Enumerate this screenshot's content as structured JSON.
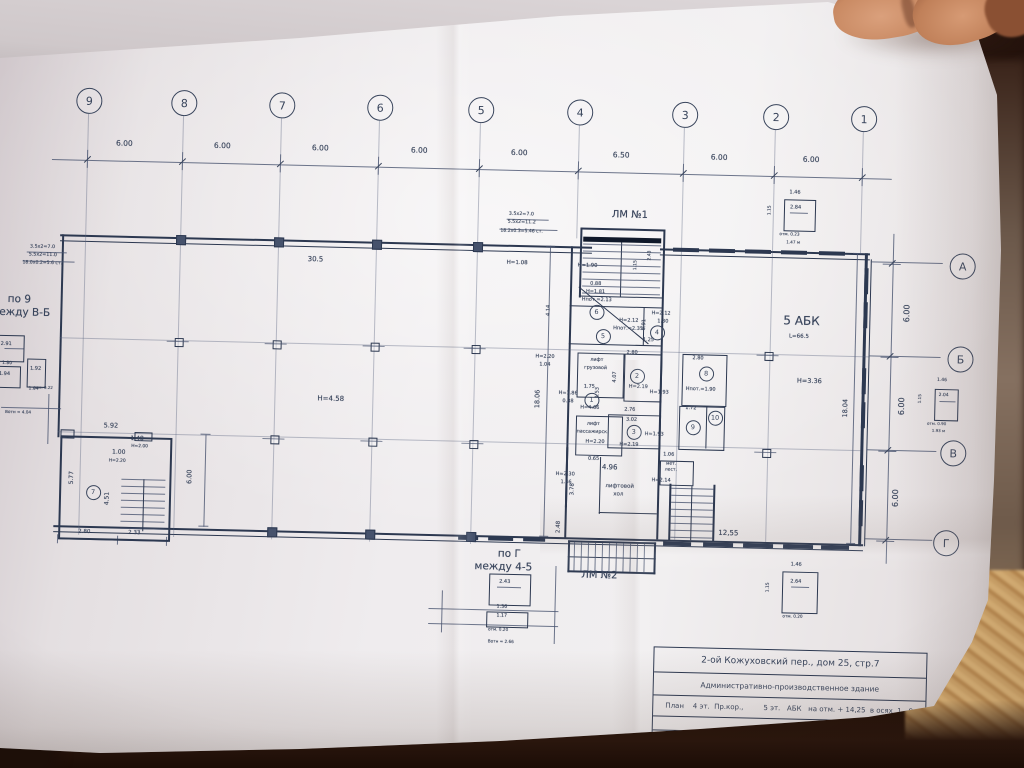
{
  "colors": {
    "ink": "#39455c",
    "paper": "#efecee",
    "background": "#2c1810",
    "carpet": "#c79e66",
    "skin": "#c98a63"
  },
  "title_block": {
    "address": "2-ой Кожуховский пер., дом 25, стр.7",
    "building": "Административно-производственное здание",
    "plan_line": "План    4 эт.  Пр.кор.,         5 эт.   АБК   на отм. + 14,25  в осях  1 - 9",
    "executor_label": "Выполнил",
    "author": "Панова А.А.",
    "date": "10.10.06"
  },
  "axis_top": {
    "bubbles": [
      {
        "n": "9",
        "x": 80
      },
      {
        "n": "8",
        "x": 175
      },
      {
        "n": "7",
        "x": 273
      },
      {
        "n": "6",
        "x": 371
      },
      {
        "n": "5",
        "x": 472
      },
      {
        "n": "4",
        "x": 571
      },
      {
        "n": "3",
        "x": 676
      },
      {
        "n": "2",
        "x": 767
      },
      {
        "n": "1",
        "x": 855
      }
    ],
    "dims": [
      {
        "t": "6.00",
        "x": 117
      },
      {
        "t": "6.00",
        "x": 215
      },
      {
        "t": "6.00",
        "x": 313
      },
      {
        "t": "6.00",
        "x": 412
      },
      {
        "t": "6.00",
        "x": 512
      },
      {
        "t": "6.50",
        "x": 614
      },
      {
        "t": "6.00",
        "x": 712
      },
      {
        "t": "6.00",
        "x": 804
      }
    ]
  },
  "axis_right": {
    "bubbles": [
      {
        "n": "А",
        "x": 957,
        "y": 213
      },
      {
        "n": "Б",
        "x": 957,
        "y": 306
      },
      {
        "n": "В",
        "x": 952,
        "y": 400
      },
      {
        "n": "Г",
        "x": 947,
        "y": 490
      }
    ],
    "dims": [
      {
        "t": "6.00",
        "x": 905,
        "y": 262
      },
      {
        "t": "6.00",
        "x": 902,
        "y": 355
      },
      {
        "t": "6.00",
        "x": 898,
        "y": 447
      }
    ]
  },
  "room_bubbles": [
    {
      "n": "7",
      "x": 93,
      "y": 459
    },
    {
      "n": "6",
      "x": 592,
      "y": 267
    },
    {
      "n": "5",
      "x": 599,
      "y": 291
    },
    {
      "n": "4",
      "x": 653,
      "y": 286
    },
    {
      "n": "2",
      "x": 634,
      "y": 330
    },
    {
      "n": "3",
      "x": 632,
      "y": 386
    },
    {
      "n": "1",
      "x": 589,
      "y": 355
    },
    {
      "n": "8",
      "x": 703,
      "y": 326
    },
    {
      "n": "10",
      "x": 713,
      "y": 370
    },
    {
      "n": "9",
      "x": 691,
      "y": 380
    }
  ],
  "annotations": [
    {
      "t": "ЛМ №1",
      "x": 606,
      "y": 166,
      "fs": 10
    },
    {
      "t": "ЛМ №2",
      "x": 584,
      "y": 527,
      "fs": 10
    },
    {
      "t": "по 9",
      "x": 4,
      "y": 264,
      "fs": 10.5
    },
    {
      "t": "между В-Б",
      "x": -12,
      "y": 277,
      "fs": 10.5
    },
    {
      "t": "по Г",
      "x": 500,
      "y": 507,
      "fs": 10.5
    },
    {
      "t": "между 4-5",
      "x": 477,
      "y": 520,
      "fs": 10.5
    },
    {
      "t": "5 АБК",
      "x": 780,
      "y": 266,
      "fs": 12
    },
    {
      "t": "L=66.5",
      "x": 786,
      "y": 286,
      "fs": 5.5
    },
    {
      "t": "Н=3.36",
      "x": 795,
      "y": 329,
      "fs": 6.5
    },
    {
      "t": "30.5",
      "x": 303,
      "y": 219,
      "fs": 7
    },
    {
      "t": "Н=4.58",
      "x": 316,
      "y": 358,
      "fs": 7
    },
    {
      "t": "3.5х2=7.0",
      "x": 25,
      "y": 214,
      "fs": 4.8
    },
    {
      "t": "5.5х2=11.0",
      "x": 24,
      "y": 222,
      "fs": 4.8
    },
    {
      "t": "18.0х0.2=5.6 ст.",
      "x": 18,
      "y": 231,
      "fs": 4.6
    },
    {
      "t": "3.5х2=7.0",
      "x": 503,
      "y": 170,
      "fs": 4.8
    },
    {
      "t": "5.5х2=11.2",
      "x": 502,
      "y": 178,
      "fs": 4.8
    },
    {
      "t": "18.2х0.3=5.46 ст.",
      "x": 495,
      "y": 188,
      "fs": 4.6
    },
    {
      "t": "Н=1.08",
      "x": 502,
      "y": 219,
      "fs": 5.5
    },
    {
      "t": "Н=1.90",
      "x": 573,
      "y": 220,
      "fs": 5.2
    },
    {
      "t": "0.88",
      "x": 586,
      "y": 238,
      "fs": 5
    },
    {
      "t": "Н=1.81",
      "x": 582,
      "y": 246,
      "fs": 5
    },
    {
      "t": "Нпот.=2.13",
      "x": 578,
      "y": 254,
      "fs": 5
    },
    {
      "t": "Н=2.12",
      "x": 616,
      "y": 274,
      "fs": 5
    },
    {
      "t": "Нпот.=2.35",
      "x": 610,
      "y": 282,
      "fs": 5
    },
    {
      "t": "Н=2.12",
      "x": 648,
      "y": 266,
      "fs": 5
    },
    {
      "t": "1.30",
      "x": 654,
      "y": 274,
      "fs": 5
    },
    {
      "t": "1.25",
      "x": 640,
      "y": 293,
      "fs": 5
    },
    {
      "t": "2.80",
      "x": 624,
      "y": 306,
      "fs": 5
    },
    {
      "t": "2.80",
      "x": 690,
      "y": 310,
      "fs": 5
    },
    {
      "t": "Нпот.=1.90",
      "x": 684,
      "y": 341,
      "fs": 5
    },
    {
      "t": "1.72",
      "x": 684,
      "y": 360,
      "fs": 5
    },
    {
      "t": "4.14",
      "x": 550,
      "y": 268,
      "fs": 5,
      "r": 1
    },
    {
      "t": "0.91",
      "x": 646,
      "y": 280,
      "fs": 5,
      "r": 1
    },
    {
      "t": "4.07",
      "x": 618,
      "y": 333,
      "fs": 5,
      "r": 1
    },
    {
      "t": "2.76",
      "x": 623,
      "y": 363,
      "fs": 5
    },
    {
      "t": "3.02",
      "x": 625,
      "y": 373,
      "fs": 5
    },
    {
      "t": "Н=1.93",
      "x": 648,
      "y": 345,
      "fs": 5
    },
    {
      "t": "Н=1.93",
      "x": 644,
      "y": 387,
      "fs": 5
    },
    {
      "t": "Н=2.19",
      "x": 627,
      "y": 340,
      "fs": 5
    },
    {
      "t": "Н=2.19",
      "x": 619,
      "y": 398,
      "fs": 5
    },
    {
      "t": "Н=2.20",
      "x": 533,
      "y": 312,
      "fs": 5
    },
    {
      "t": "1.04",
      "x": 537,
      "y": 320,
      "fs": 5
    },
    {
      "t": "Н=1.86",
      "x": 557,
      "y": 348,
      "fs": 5
    },
    {
      "t": "0.88",
      "x": 561,
      "y": 356,
      "fs": 5
    },
    {
      "t": "1.75",
      "x": 582,
      "y": 341,
      "fs": 5
    },
    {
      "t": "1.53",
      "x": 601,
      "y": 349,
      "fs": 5,
      "r": 1
    },
    {
      "t": "Н=4.66",
      "x": 579,
      "y": 362,
      "fs": 5
    },
    {
      "t": "лифт",
      "x": 588,
      "y": 314,
      "fs": 4.8
    },
    {
      "t": "грузовой",
      "x": 582,
      "y": 322,
      "fs": 4.8
    },
    {
      "t": "лифт",
      "x": 586,
      "y": 378,
      "fs": 4.8
    },
    {
      "t": "пассажирск.",
      "x": 576,
      "y": 386,
      "fs": 4.8
    },
    {
      "t": "Н=2.20",
      "x": 585,
      "y": 396,
      "fs": 5
    },
    {
      "t": "18.06",
      "x": 537,
      "y": 356,
      "fs": 6.5,
      "r": 1
    },
    {
      "t": "18.04",
      "x": 845,
      "y": 358,
      "fs": 6.5,
      "r": 1
    },
    {
      "t": "0.65",
      "x": 588,
      "y": 413,
      "fs": 5
    },
    {
      "t": "4.96",
      "x": 602,
      "y": 420,
      "fs": 7
    },
    {
      "t": "Н=2.30",
      "x": 556,
      "y": 429,
      "fs": 5
    },
    {
      "t": "1.46",
      "x": 561,
      "y": 437,
      "fs": 5
    },
    {
      "t": "3.78",
      "x": 578,
      "y": 446,
      "fs": 5.5,
      "r": 1
    },
    {
      "t": "лифтовой",
      "x": 606,
      "y": 440,
      "fs": 5.5
    },
    {
      "t": "хол",
      "x": 614,
      "y": 448,
      "fs": 5.5
    },
    {
      "t": "мет.",
      "x": 666,
      "y": 417,
      "fs": 4.5
    },
    {
      "t": "лест.",
      "x": 665,
      "y": 423,
      "fs": 4.5
    },
    {
      "t": "1.06",
      "x": 663,
      "y": 407,
      "fs": 5
    },
    {
      "t": "Н=2.14",
      "x": 652,
      "y": 433,
      "fs": 5
    },
    {
      "t": "2.48",
      "x": 565,
      "y": 484,
      "fs": 5.5,
      "r": 1
    },
    {
      "t": "12,55",
      "x": 720,
      "y": 483,
      "fs": 7
    },
    {
      "t": "5.92",
      "x": 103,
      "y": 390,
      "fs": 6.5
    },
    {
      "t": "1.48",
      "x": 130,
      "y": 403,
      "fs": 6
    },
    {
      "t": "1.00",
      "x": 112,
      "y": 417,
      "fs": 6
    },
    {
      "t": "Н=2.00",
      "x": 131,
      "y": 412,
      "fs": 4.4
    },
    {
      "t": "Н=2.20",
      "x": 109,
      "y": 427,
      "fs": 4.4
    },
    {
      "t": "5.77",
      "x": 76,
      "y": 446,
      "fs": 6,
      "r": 1
    },
    {
      "t": "4.51",
      "x": 112,
      "y": 466,
      "fs": 6,
      "r": 1
    },
    {
      "t": "6.00",
      "x": 193,
      "y": 442,
      "fs": 6.5,
      "r": 1
    },
    {
      "t": "2.80",
      "x": 80,
      "y": 498,
      "fs": 5.5
    },
    {
      "t": "2.33",
      "x": 130,
      "y": 498,
      "fs": 5.5
    },
    {
      "t": "1.15",
      "x": 637,
      "y": 221,
      "fs": 4.5,
      "r": 1
    },
    {
      "t": "2.43",
      "x": 651,
      "y": 211,
      "fs": 4.5,
      "r": 1
    },
    {
      "t": "1.46",
      "x": 783,
      "y": 142,
      "fs": 5
    },
    {
      "t": "2.84",
      "x": 784,
      "y": 157,
      "fs": 5
    },
    {
      "t": "1.15",
      "x": 770,
      "y": 163,
      "fs": 4.4,
      "r": 1
    },
    {
      "t": "отм. 0.23",
      "x": 774,
      "y": 184,
      "fs": 4.2
    },
    {
      "t": "1.47 м",
      "x": 781,
      "y": 192,
      "fs": 4.2
    },
    {
      "t": "1.46",
      "x": 935,
      "y": 327,
      "fs": 4.5
    },
    {
      "t": "2.04",
      "x": 937,
      "y": 342,
      "fs": 4.5
    },
    {
      "t": "1.15",
      "x": 924,
      "y": 348,
      "fs": 4.2,
      "r": 1
    },
    {
      "t": "отм. 0.90",
      "x": 926,
      "y": 370,
      "fs": 4
    },
    {
      "t": "1.93 м",
      "x": 931,
      "y": 377,
      "fs": 4
    },
    {
      "t": "1.46",
      "x": 793,
      "y": 514,
      "fs": 5
    },
    {
      "t": "2.64",
      "x": 793,
      "y": 531,
      "fs": 5
    },
    {
      "t": "1.15",
      "x": 777,
      "y": 540,
      "fs": 4.4,
      "r": 1
    },
    {
      "t": "отм. 0.20",
      "x": 786,
      "y": 566,
      "fs": 4.2
    },
    {
      "t": "2.91",
      "x": -2,
      "y": 312,
      "fs": 5
    },
    {
      "t": "1.80",
      "x": 0,
      "y": 332,
      "fs": 4.5
    },
    {
      "t": "1.94",
      "x": -3,
      "y": 342,
      "fs": 5
    },
    {
      "t": "1.92",
      "x": 28,
      "y": 336,
      "fs": 5
    },
    {
      "t": "1.04",
      "x": 27,
      "y": 357,
      "fs": 4.5
    },
    {
      "t": "отм. 0.22",
      "x": 32,
      "y": 355,
      "fs": 4
    },
    {
      "t": "Вотн = 4.04",
      "x": 4,
      "y": 380,
      "fs": 4.2
    },
    {
      "t": "2.43",
      "x": 502,
      "y": 538,
      "fs": 5
    },
    {
      "t": "1.36",
      "x": 500,
      "y": 563,
      "fs": 4.8
    },
    {
      "t": "1.17",
      "x": 500,
      "y": 572,
      "fs": 4.8
    },
    {
      "t": "отм. 0.20",
      "x": 492,
      "y": 586,
      "fs": 4.2
    },
    {
      "t": "Вотн = 2.66",
      "x": 492,
      "y": 598,
      "fs": 4.2
    }
  ]
}
